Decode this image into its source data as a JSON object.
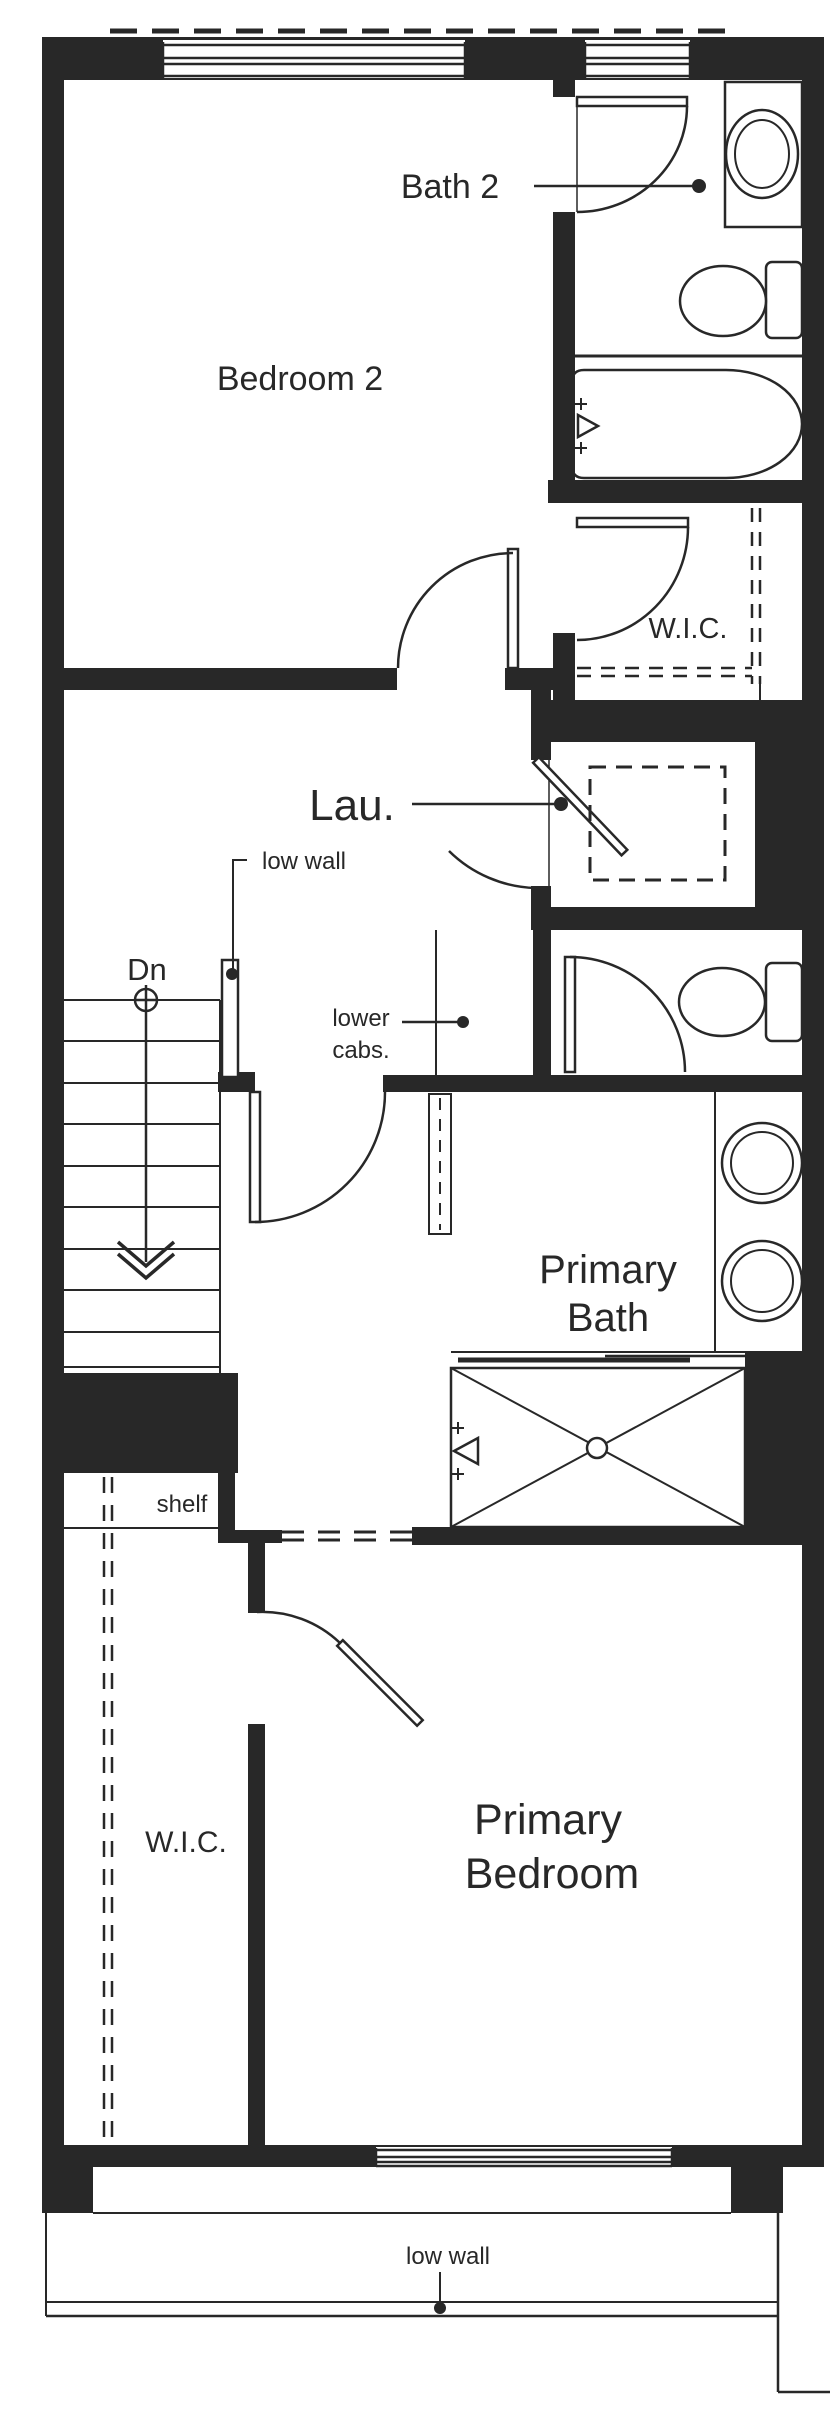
{
  "rooms": {
    "bedroom2": {
      "label": "Bedroom 2"
    },
    "bath2": {
      "label": "Bath 2"
    },
    "wic_upper": {
      "label": "W.I.C."
    },
    "laundry": {
      "label": "Lau."
    },
    "primary_bath": {
      "label_line1": "Primary",
      "label_line2": "Bath"
    },
    "primary_bedroom": {
      "label_line1": "Primary",
      "label_line2": "Bedroom"
    },
    "wic_lower": {
      "label": "W.I.C."
    }
  },
  "annotations": {
    "low_wall_mid": "low wall",
    "low_wall_bottom": "low wall",
    "lower_cabs_line1": "lower",
    "lower_cabs_line2": "cabs.",
    "shelf": "shelf",
    "stairs_down": "Dn"
  },
  "fixtures": {
    "bath2_vanity_sink": "sink-vanity-icon",
    "bath2_toilet": "toilet-icon",
    "bathtub": "bathtub-icon",
    "washer_dryer": "stacked-washer-dryer-icon",
    "primary_toilet": "toilet-icon",
    "primary_sink_1": "round-sink-icon",
    "primary_sink_2": "round-sink-icon",
    "shower": "shower-pan-icon",
    "shower_head": "shower-head-icon",
    "tub_faucet": "faucet-icon"
  },
  "colors": {
    "wall": "#282828",
    "background": "#ffffff"
  }
}
